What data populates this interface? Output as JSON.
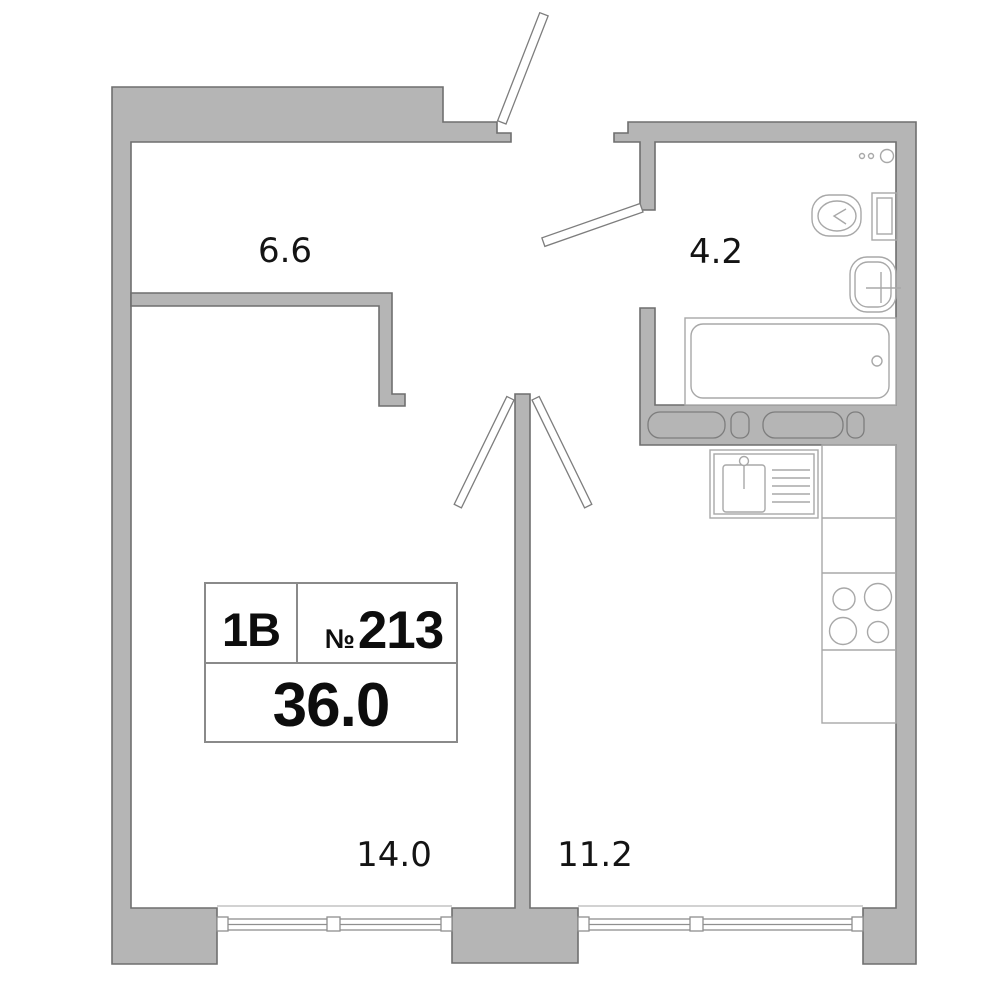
{
  "title": "Apartment floor plan",
  "unit": {
    "type": "1В",
    "number_sign": "№",
    "number": "213",
    "total_area": "36.0"
  },
  "rooms": [
    {
      "id": "hallway",
      "area": "6.6"
    },
    {
      "id": "bathroom",
      "area": "4.2"
    },
    {
      "id": "living_room",
      "area": "14.0"
    },
    {
      "id": "kitchen",
      "area": "11.2"
    }
  ],
  "fixtures": [
    "entry-door",
    "bathroom-door",
    "living-room-door",
    "kitchen-door",
    "toilet",
    "washbasin",
    "bathtub",
    "ventilation-shafts",
    "kitchen-sink",
    "counter",
    "stove-4-burners",
    "living-room-window",
    "kitchen-window"
  ],
  "colors": {
    "background": "#ffffff",
    "wall_fill": "#b5b5b5",
    "wall_stroke": "#6f6f6f",
    "fixture_stroke": "#a8a8a8",
    "window_stroke": "#8f8f8f",
    "text": "#141414"
  }
}
